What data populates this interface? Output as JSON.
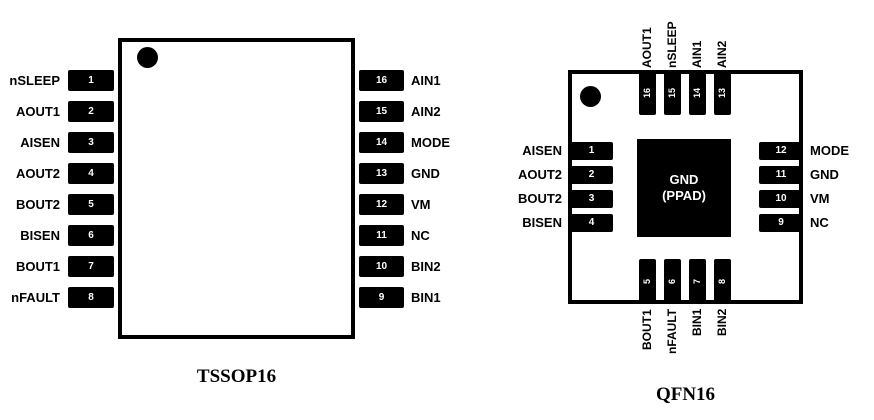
{
  "colors": {
    "ink": "#000000",
    "paper": "#ffffff",
    "pin_number_text": "#ffffff"
  },
  "tssop": {
    "caption": "TSSOP16",
    "left_pins": [
      {
        "num": "1",
        "name": "nSLEEP"
      },
      {
        "num": "2",
        "name": "AOUT1"
      },
      {
        "num": "3",
        "name": "AISEN"
      },
      {
        "num": "4",
        "name": "AOUT2"
      },
      {
        "num": "5",
        "name": "BOUT2"
      },
      {
        "num": "6",
        "name": "BISEN"
      },
      {
        "num": "7",
        "name": "BOUT1"
      },
      {
        "num": "8",
        "name": "nFAULT"
      }
    ],
    "right_pins": [
      {
        "num": "16",
        "name": "AIN1"
      },
      {
        "num": "15",
        "name": "AIN2"
      },
      {
        "num": "14",
        "name": "MODE"
      },
      {
        "num": "13",
        "name": "GND"
      },
      {
        "num": "12",
        "name": "VM"
      },
      {
        "num": "11",
        "name": "NC"
      },
      {
        "num": "10",
        "name": "BIN2"
      },
      {
        "num": "9",
        "name": "BIN1"
      }
    ]
  },
  "qfn": {
    "caption": "QFN16",
    "pad": {
      "line1": "GND",
      "line2": "(PPAD)"
    },
    "top_pins": [
      {
        "num": "16",
        "name": "AOUT1"
      },
      {
        "num": "15",
        "name": "nSLEEP"
      },
      {
        "num": "14",
        "name": "AIN1"
      },
      {
        "num": "13",
        "name": "AIN2"
      }
    ],
    "left_pins": [
      {
        "num": "1",
        "name": "AISEN"
      },
      {
        "num": "2",
        "name": "AOUT2"
      },
      {
        "num": "3",
        "name": "BOUT2"
      },
      {
        "num": "4",
        "name": "BISEN"
      }
    ],
    "right_pins": [
      {
        "num": "12",
        "name": "MODE"
      },
      {
        "num": "11",
        "name": "GND"
      },
      {
        "num": "10",
        "name": "VM"
      },
      {
        "num": "9",
        "name": "NC"
      }
    ],
    "bottom_pins": [
      {
        "num": "5",
        "name": "BOUT1"
      },
      {
        "num": "6",
        "name": "nFAULT"
      },
      {
        "num": "7",
        "name": "BIN1"
      },
      {
        "num": "8",
        "name": "BIN2"
      }
    ]
  }
}
